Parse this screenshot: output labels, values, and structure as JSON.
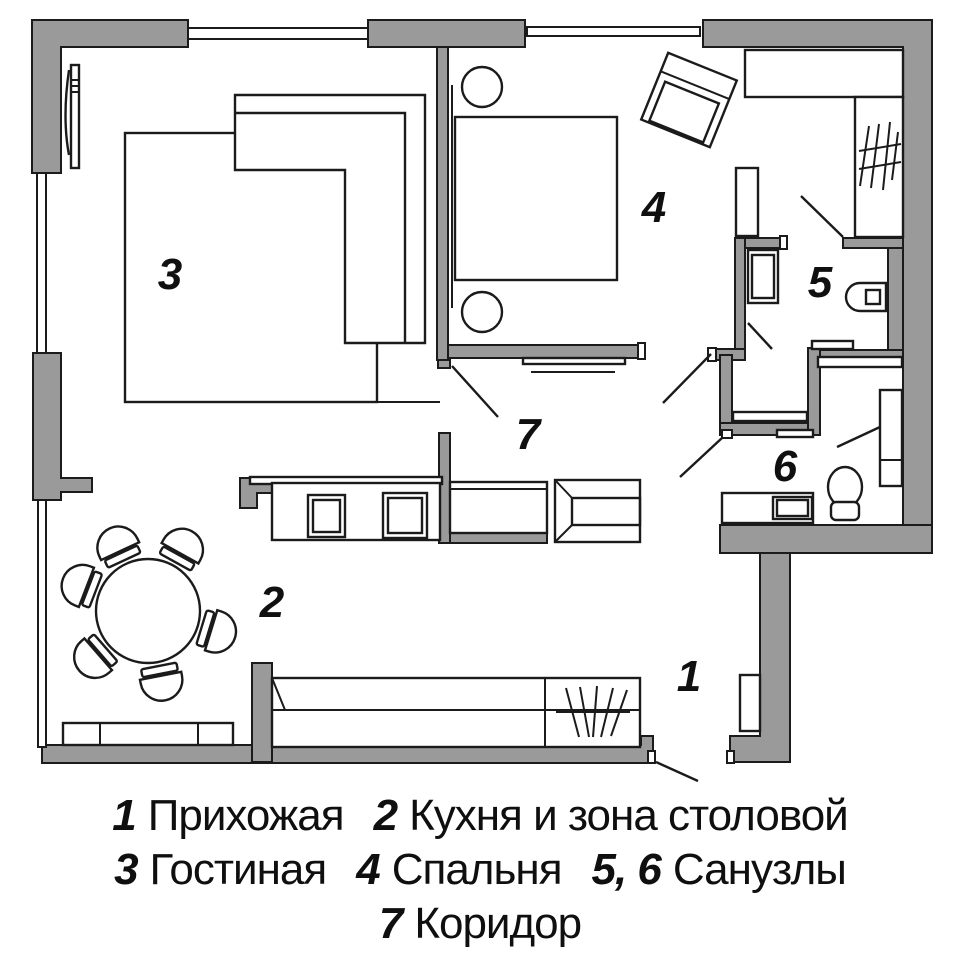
{
  "colors": {
    "wall": "#9a9a9a",
    "line": "#1b1b1b",
    "background": "#ffffff"
  },
  "room_labels": {
    "r1": "1",
    "r2": "2",
    "r3": "3",
    "r4": "4",
    "r5": "5",
    "r6": "6",
    "r7": "7"
  },
  "legend": {
    "lines": [
      {
        "entries": [
          {
            "num": "1",
            "name": "Прихожая"
          },
          {
            "num": "2",
            "name": "Кухня и зона столовой"
          }
        ]
      },
      {
        "entries": [
          {
            "num": "3",
            "name": "Гостиная"
          },
          {
            "num": "4",
            "name": "Спальня"
          },
          {
            "num": "5, 6",
            "name": "Санузлы"
          }
        ]
      },
      {
        "entries": [
          {
            "num": "7",
            "name": "Коридор"
          }
        ]
      }
    ]
  }
}
